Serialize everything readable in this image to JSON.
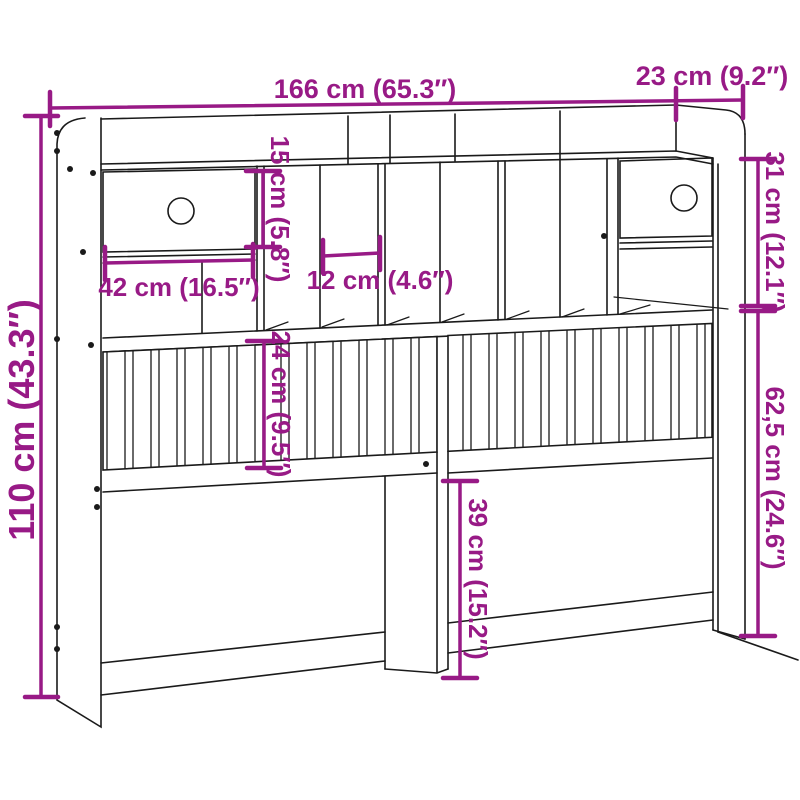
{
  "colors": {
    "dimension": "#981A86",
    "line": "#1a1a1a",
    "background": "#ffffff"
  },
  "drawing": {
    "subject": "headboard-with-storage-line-drawing"
  },
  "dimensions": {
    "width": "166 cm (65.3″)",
    "depth": "23 cm (9.2″)",
    "opening_height": "15 cm (5.8″)",
    "top_section_height": "31 cm (12.1″)",
    "drawer_width": "42 cm (16.5″)",
    "compartment_width": "12 cm (4.6″)",
    "total_height": "110 cm (43.3″)",
    "slat_panel_height": "24 cm (9.5″)",
    "lower_section_height": "62,5 cm (24.6″)",
    "leg_section_height": "39 cm (15.2″)"
  }
}
